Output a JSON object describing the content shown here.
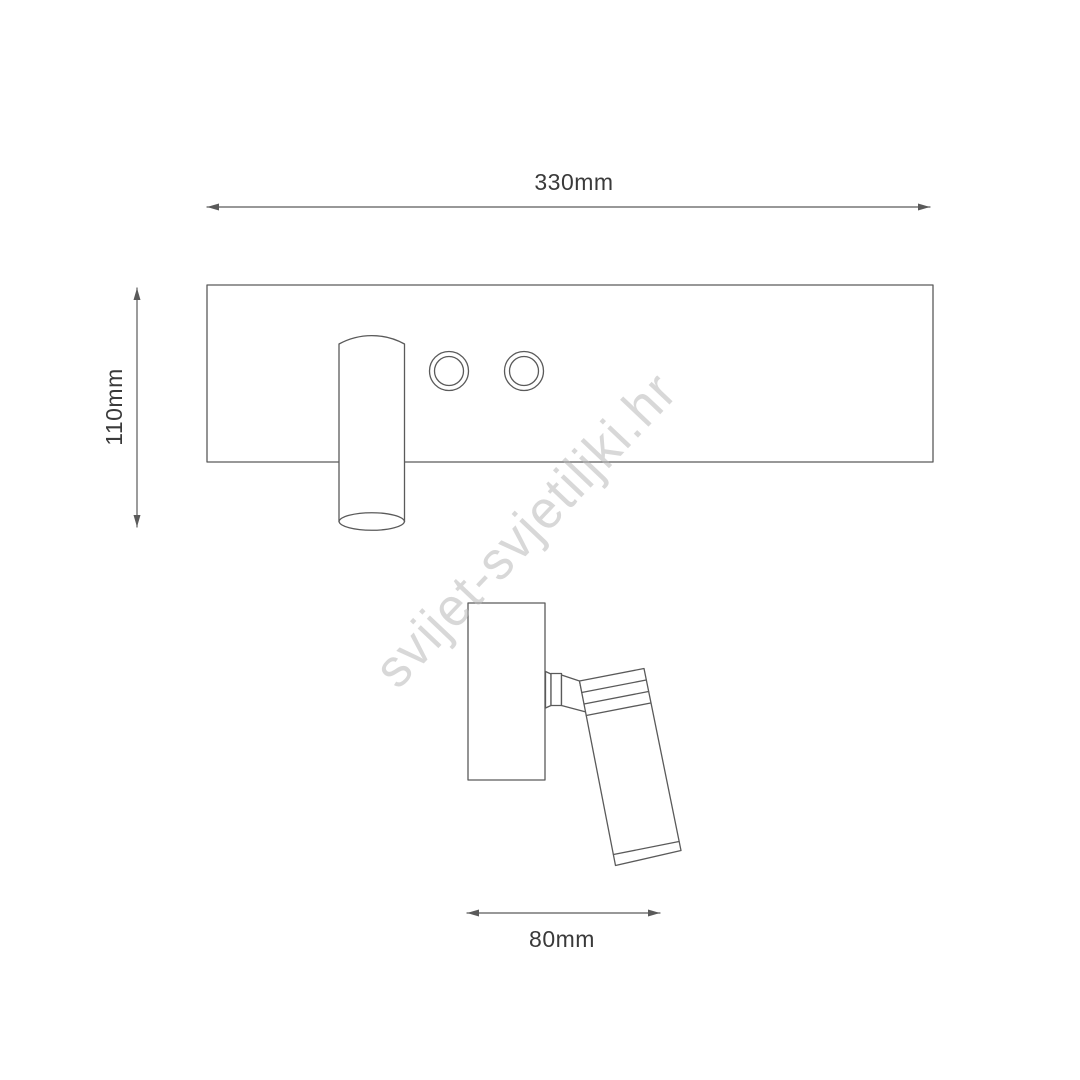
{
  "watermark": {
    "text": "svijet-svjetiljki.hr"
  },
  "dimensions": {
    "overall_width": {
      "label": "330mm",
      "value_mm": 330
    },
    "overall_height": {
      "label": "110mm",
      "value_mm": 110
    },
    "head_depth": {
      "label": "80mm",
      "value_mm": 80
    }
  },
  "colors": {
    "line": "#5a5a5a",
    "dimension_text": "#3a3a3a",
    "watermark": "#b8b8b8",
    "background": "#ffffff"
  }
}
